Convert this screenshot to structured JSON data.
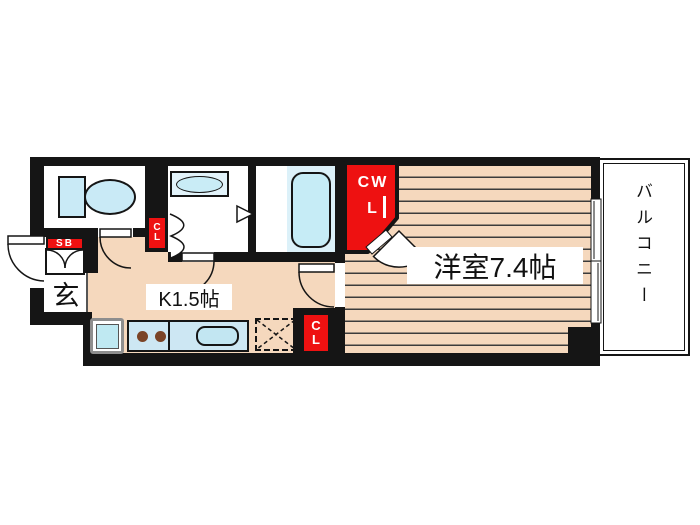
{
  "plan": {
    "type": "apartment-floor-plan",
    "rooms": {
      "entrance": {
        "label": "玄"
      },
      "kitchen": {
        "label": "K1.5帖"
      },
      "main_room": {
        "label": "洋室7.4帖"
      },
      "balcony": {
        "label": "バルコニー"
      }
    },
    "storage": {
      "shoe_box": {
        "label": "SB"
      },
      "hall_closet": {
        "lines": [
          "C",
          "L"
        ]
      },
      "walk_in_closet": {
        "lines": [
          "CW",
          "L"
        ]
      },
      "kitchen_closet": {
        "lines": [
          "C",
          "L"
        ]
      }
    },
    "colors": {
      "wall": "#151515",
      "floor": "#f5d8bd",
      "accent_red": "#ee1111",
      "fixture_blue": "#c9eaf6",
      "counter_blue": "#cde7f3"
    }
  }
}
